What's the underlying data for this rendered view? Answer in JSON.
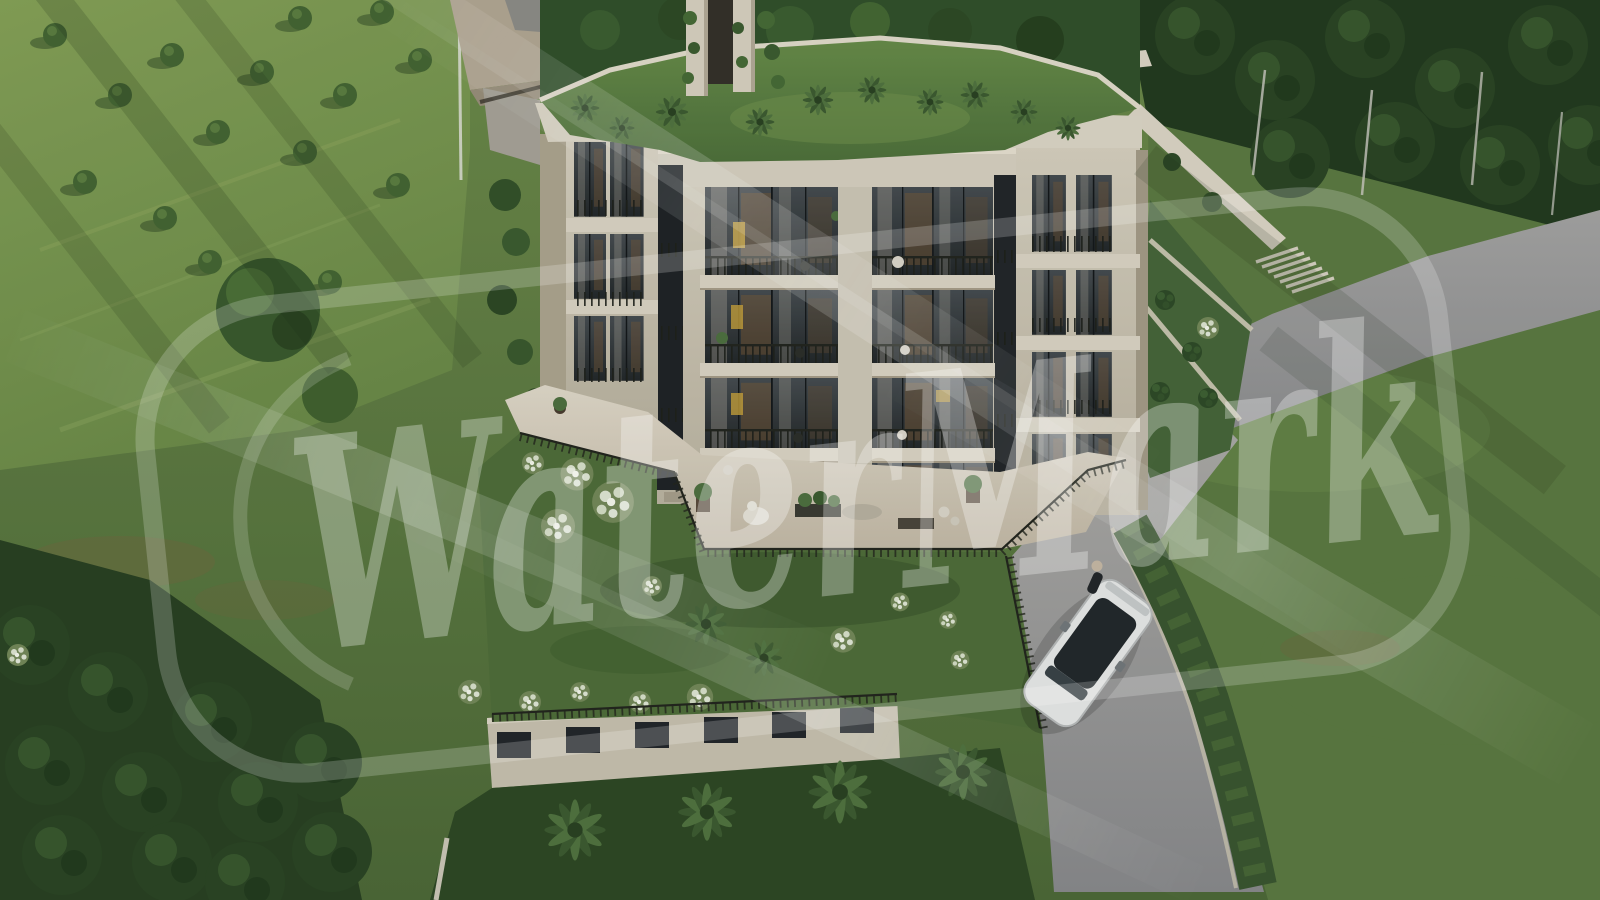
{
  "watermark": {
    "text": "WaterMark",
    "color": "#ffffff",
    "text_opacity": 0.3,
    "frame_opacity": 0.2
  },
  "scene": {
    "type": "aerial-3d-architectural-render",
    "subject": "modern-apartment-building-with-rooftop-garden",
    "building": {
      "visible_floors": 4,
      "center_window_bays": 2,
      "basement_windows": 6,
      "facade_color": "#d6cfbf",
      "glass_color": "#2b3034",
      "slab_color": "#dcd5c6"
    },
    "landscape": {
      "lawn": "#6e8a4c",
      "meadow": "#83a058",
      "forest": "#2a4224",
      "roof_lawn": "#648748",
      "road": "#9a9a9c",
      "pavement": "#d9d0bf",
      "hedge": "#3a5530"
    },
    "car": {
      "body_color": "#e9eaea",
      "glass_color": "#23282c"
    },
    "people_count": 1,
    "front_palm_trees": 4
  }
}
